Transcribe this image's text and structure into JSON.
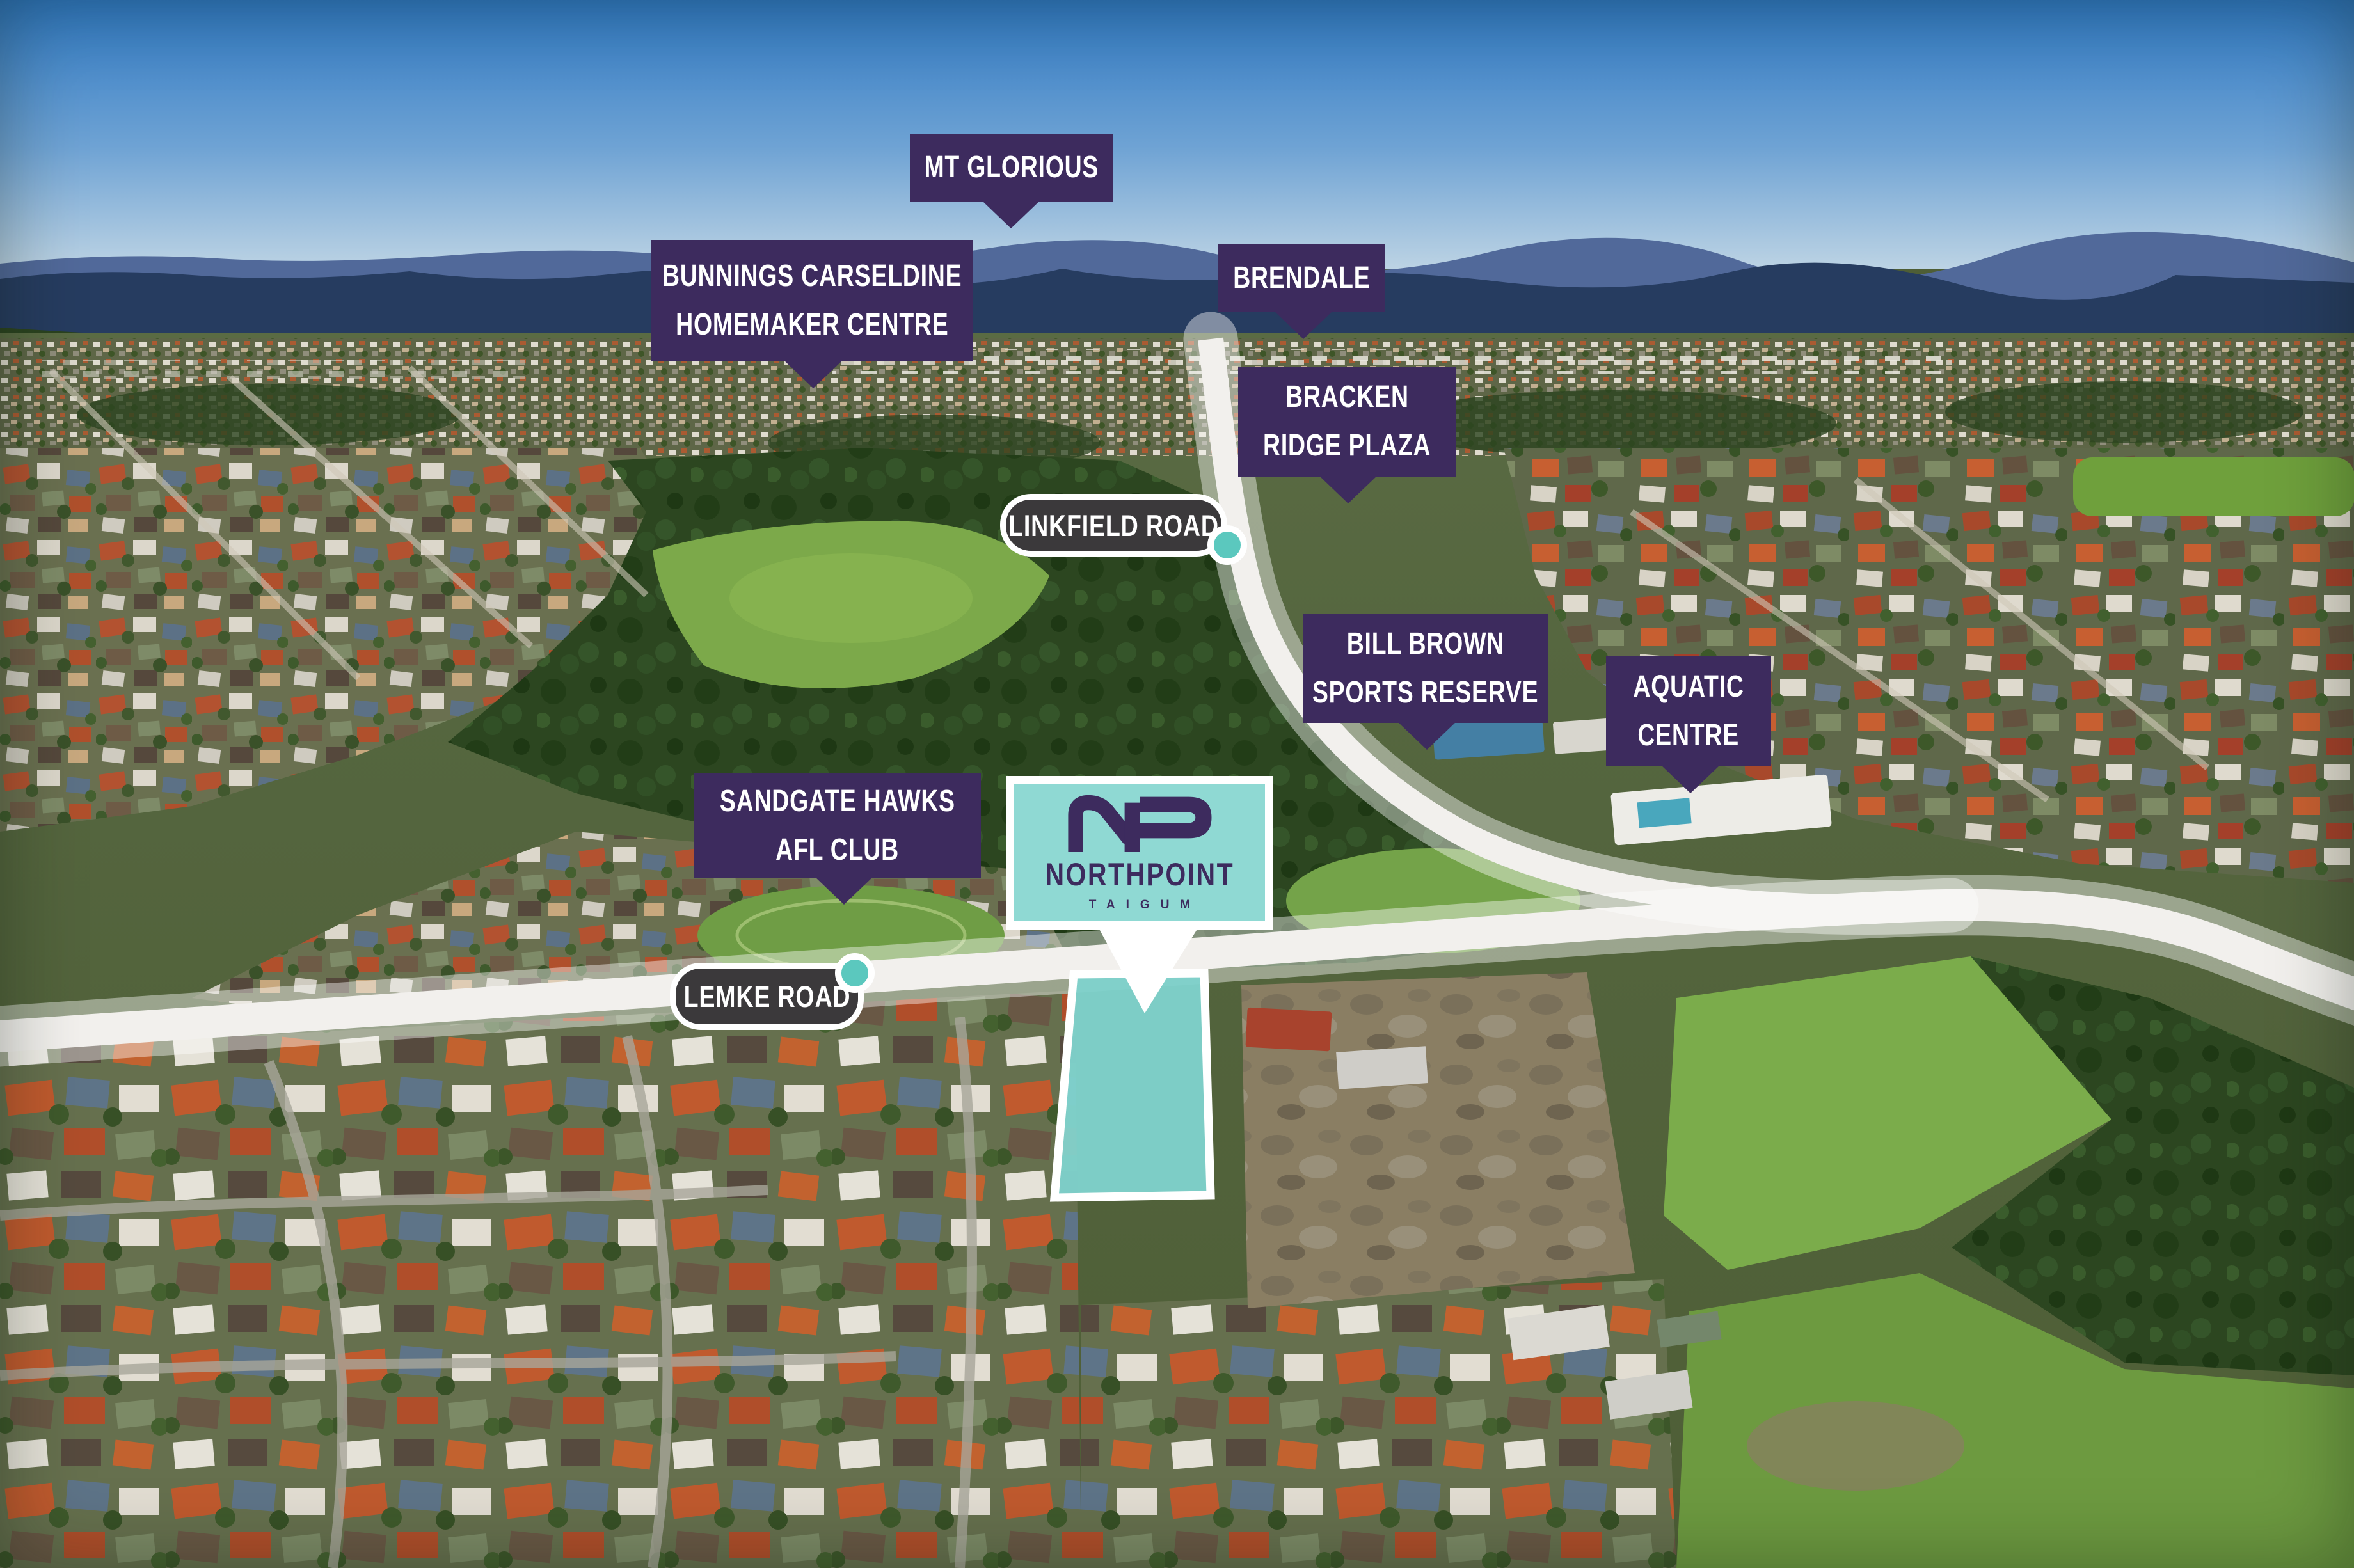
{
  "title": "Northpoint Taigum aerial amenity map",
  "colors": {
    "label_purple": "#3D2B5E",
    "logo_teal": "#8FD9D3",
    "marker_teal": "#5BC8BE",
    "road_label_bg": "#3B393B",
    "site_highlight": "#7FD3CD",
    "label_text": "#FFFFFF"
  },
  "labels": {
    "mt_glorious": {
      "line1": "MT GLORIOUS"
    },
    "bunnings": {
      "line1": "BUNNINGS CARSELDINE",
      "line2": "HOMEMAKER CENTRE"
    },
    "brendale": {
      "line1": "BRENDALE"
    },
    "bracken_ridge": {
      "line1": "BRACKEN",
      "line2": "RIDGE PLAZA"
    },
    "bill_brown": {
      "line1": "BILL BROWN",
      "line2": "SPORTS RESERVE"
    },
    "aquatic_centre": {
      "line1": "AQUATIC",
      "line2": "CENTRE"
    },
    "sandgate_hawks": {
      "line1": "SANDGATE HAWKS",
      "line2": "AFL CLUB"
    },
    "linkfield_road": {
      "text": "LINKFIELD ROAD"
    },
    "lemke_road": {
      "text": "LEMKE ROAD"
    }
  },
  "logo": {
    "monogram": "NP",
    "name": "NORTHPOINT",
    "suburb": "TAIGUM"
  },
  "site": {
    "name": "Northpoint Taigum development site",
    "highlight_shape": "trapezoid parcel fronting Lemke Road"
  }
}
